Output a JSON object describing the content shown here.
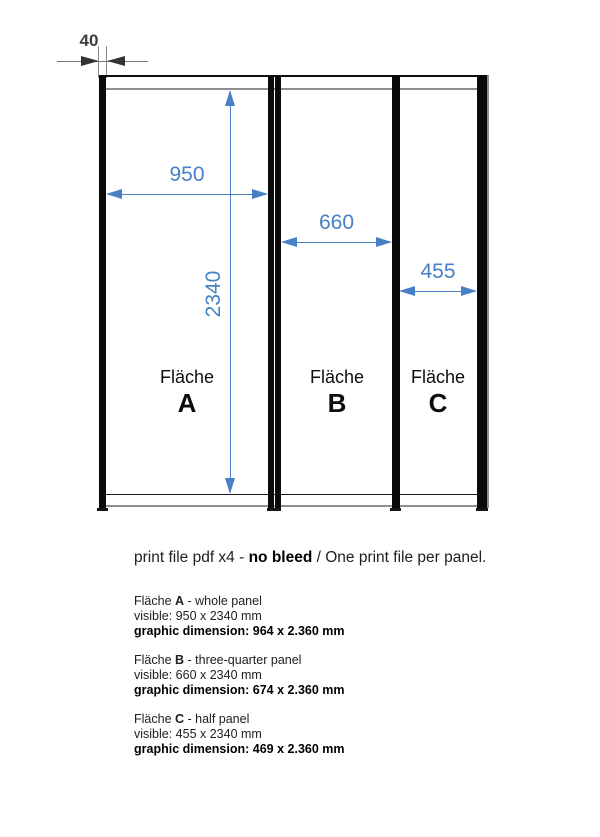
{
  "drawing": {
    "post_width_label": "40",
    "dims": {
      "panel_a_width": "950",
      "panel_b_width": "660",
      "panel_c_width": "455",
      "panel_height": "2340"
    },
    "panels": [
      {
        "label": "Fläche",
        "letter": "A"
      },
      {
        "label": "Fläche",
        "letter": "B"
      },
      {
        "label": "Fläche",
        "letter": "C"
      }
    ],
    "colors": {
      "dimension_blue": "#4780c4",
      "frame_black": "#0a0a0a",
      "rail_gray": "#8f8f8f",
      "annotation_gray": "#3d3d3d"
    }
  },
  "note": {
    "prefix": "print file pdf x4 - ",
    "bold": "no bleed",
    "suffix": " / One print file per panel."
  },
  "specs": [
    {
      "name": "Fläche ",
      "letter": "A",
      "desc": " - whole panel",
      "visible": "visible: 950 x 2340 mm",
      "graphic": "graphic dimension: 964 x 2.360 mm"
    },
    {
      "name": "Fläche ",
      "letter": "B",
      "desc": " - three-quarter panel",
      "visible": "visible: 660 x 2340 mm",
      "graphic": "graphic dimension: 674 x 2.360 mm"
    },
    {
      "name": "Fläche ",
      "letter": "C",
      "desc": " - half panel",
      "visible": "visible: 455 x 2340 mm",
      "graphic": "graphic dimension: 469 x 2.360 mm"
    }
  ]
}
